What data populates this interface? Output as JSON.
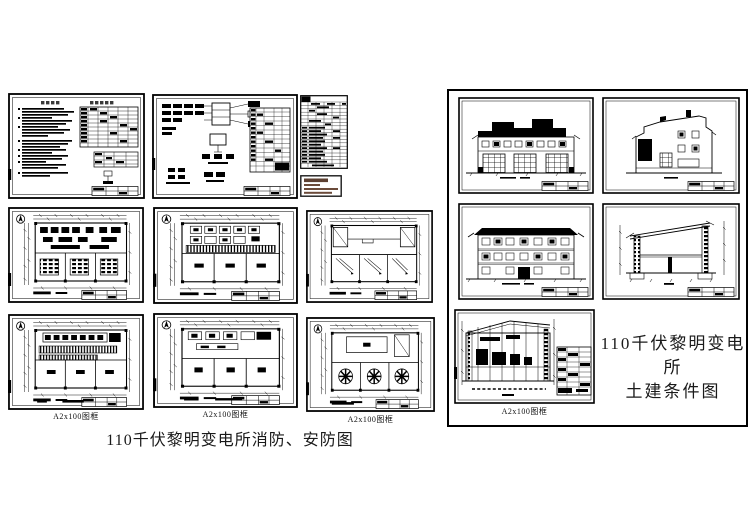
{
  "fire": {
    "caption": "110千伏黎明变电所消防、安防图",
    "sheet_captions": [
      "A2x100图框",
      "A2x100图框",
      "A2x100图框"
    ]
  },
  "civil": {
    "title1": "110千伏黎明变电所",
    "title2": "土建条件图",
    "caption": "A2x100图框"
  }
}
